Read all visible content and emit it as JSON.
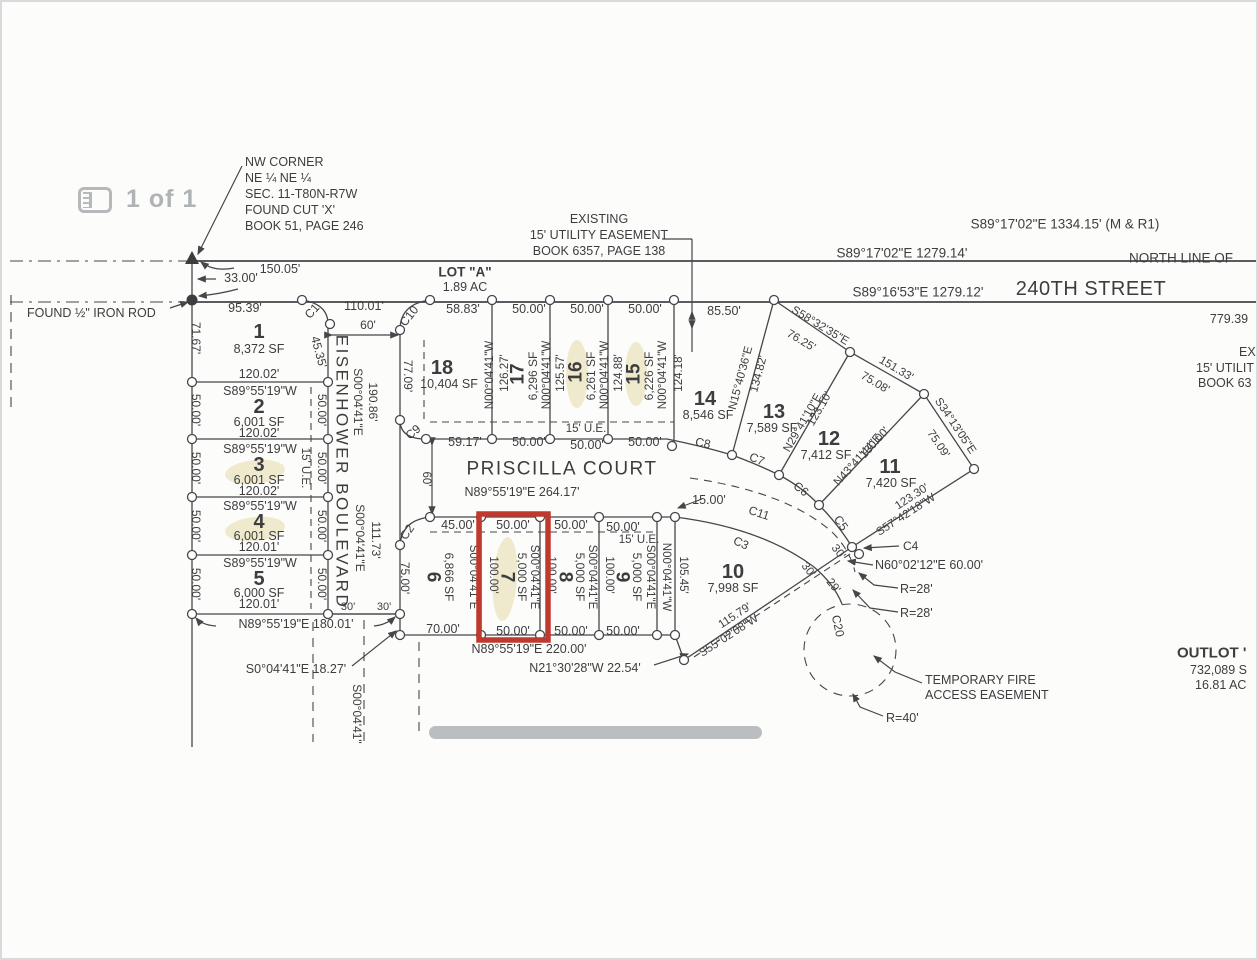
{
  "page": {
    "indicator": "1 of 1"
  },
  "colors": {
    "ink": "#3c3d3f",
    "muted_gray": "#b0b3b6",
    "highlight_red": "#c0392f",
    "redaction_gray": "#b4b7b9",
    "marker_yellow": "#ece4c2"
  },
  "summary": {
    "highlighted_lot": "7",
    "streets": [
      "240TH STREET",
      "EISENHOWER BOULEVARD",
      "PRISCILLA COURT"
    ],
    "outlot_a": {
      "label": "LOT \"A\"",
      "area": "1.89 AC"
    },
    "lots": [
      {
        "lot": "1",
        "area": "8,372 SF"
      },
      {
        "lot": "2",
        "area": "6,001 SF"
      },
      {
        "lot": "3",
        "area": "6,001 SF"
      },
      {
        "lot": "4",
        "area": "6,001 SF"
      },
      {
        "lot": "5",
        "area": "6,000 SF"
      },
      {
        "lot": "6",
        "area": "6,866 SF"
      },
      {
        "lot": "7",
        "area": "5,000 SF"
      },
      {
        "lot": "8",
        "area": "5,000 SF"
      },
      {
        "lot": "9",
        "area": "5,000 SF"
      },
      {
        "lot": "10",
        "area": "7,998 SF"
      },
      {
        "lot": "11",
        "area": "7,420 SF"
      },
      {
        "lot": "12",
        "area": "7,412 SF"
      },
      {
        "lot": "13",
        "area": "7,589 SF"
      },
      {
        "lot": "14",
        "area": "8,546 SF"
      },
      {
        "lot": "15",
        "area": "6,226 SF"
      },
      {
        "lot": "16",
        "area": "6,261 SF"
      },
      {
        "lot": "17",
        "area": "6,296 SF"
      },
      {
        "lot": "18",
        "area": "10,404 SF"
      }
    ]
  },
  "plat": {
    "labels": [
      {
        "t": "NW CORNER",
        "x": 243,
        "y": 160,
        "a": "start"
      },
      {
        "t": "NE ¼ NE ¼",
        "x": 243,
        "y": 176,
        "a": "start"
      },
      {
        "t": "SEC. 11-T80N-R7W",
        "x": 243,
        "y": 192,
        "a": "start"
      },
      {
        "t": "FOUND CUT 'X'",
        "x": 243,
        "y": 208,
        "a": "start"
      },
      {
        "t": "BOOK 51, PAGE 246",
        "x": 243,
        "y": 224,
        "a": "start"
      },
      {
        "t": "FOUND ½\" IRON ROD",
        "x": 25,
        "y": 311,
        "a": "start"
      },
      {
        "t": "EXISTING",
        "x": 597,
        "y": 217
      },
      {
        "t": "15' UTILITY EASEMENT",
        "x": 597,
        "y": 233
      },
      {
        "t": "BOOK 6357, PAGE 138",
        "x": 597,
        "y": 249
      },
      {
        "t": "S89°17'02\"E 1334.15' (M & R1)",
        "x": 1063,
        "y": 222,
        "s": 13.5
      },
      {
        "t": "S89°17'02\"E 1279.14'",
        "x": 900,
        "y": 251,
        "s": 13.5
      },
      {
        "t": "NORTH LINE OF",
        "x": 1127,
        "y": 256,
        "a": "start",
        "s": 13.5
      },
      {
        "t": "240TH STREET",
        "x": 1089,
        "y": 287,
        "s": 20,
        "ls": 0.5
      },
      {
        "t": "S89°16'53\"E 1279.12'",
        "x": 916,
        "y": 290,
        "s": 13.5
      },
      {
        "t": "779.39",
        "x": 1227,
        "y": 317
      },
      {
        "t": "150.05'",
        "x": 278,
        "y": 267
      },
      {
        "t": "33.00'",
        "x": 239,
        "y": 276
      },
      {
        "t": "95.39'",
        "x": 243,
        "y": 306
      },
      {
        "t": "110.01'",
        "x": 362,
        "y": 304
      },
      {
        "t": "LOT \"A\"",
        "x": 463,
        "y": 270,
        "s": 13.5,
        "w": 1
      },
      {
        "t": "1.89 AC",
        "x": 463,
        "y": 285
      },
      {
        "t": "58.83'",
        "x": 461,
        "y": 307
      },
      {
        "t": "50.00'",
        "x": 527,
        "y": 307
      },
      {
        "t": "50.00'",
        "x": 585,
        "y": 307
      },
      {
        "t": "50.00'",
        "x": 643,
        "y": 307
      },
      {
        "t": "85.50'",
        "x": 722,
        "y": 309
      },
      {
        "t": "60'",
        "x": 366,
        "y": 323,
        "s": 12
      },
      {
        "t": "C1",
        "x": 310,
        "y": 309,
        "r": -48,
        "s": 12
      },
      {
        "t": "C10",
        "x": 407,
        "y": 314,
        "r": -52,
        "s": 12
      },
      {
        "t": "EX",
        "x": 1237,
        "y": 350,
        "a": "start"
      },
      {
        "t": "15' UTILIT",
        "x": 1194,
        "y": 366,
        "a": "start"
      },
      {
        "t": "BOOK 63",
        "x": 1196,
        "y": 381,
        "a": "start"
      },
      {
        "t": "OUTLOT '",
        "x": 1175,
        "y": 651,
        "a": "start",
        "s": 15,
        "w": 1
      },
      {
        "t": "732,089 S",
        "x": 1188,
        "y": 668,
        "a": "start"
      },
      {
        "t": "16.81 AC",
        "x": 1193,
        "y": 683,
        "a": "start"
      },
      {
        "t": "1",
        "x": 257,
        "y": 330,
        "s": 20,
        "w": 1
      },
      {
        "t": "8,372 SF",
        "x": 257,
        "y": 347
      },
      {
        "t": "120.02'",
        "x": 257,
        "y": 372
      },
      {
        "t": "S89°55'19\"W",
        "x": 258,
        "y": 389
      },
      {
        "t": "2",
        "x": 257,
        "y": 405,
        "s": 20,
        "w": 1
      },
      {
        "t": "6,001 SF",
        "x": 257,
        "y": 420
      },
      {
        "t": "120.02'",
        "x": 257,
        "y": 431
      },
      {
        "t": "S89°55'19\"W",
        "x": 258,
        "y": 447
      },
      {
        "t": "3",
        "x": 257,
        "y": 463,
        "s": 20,
        "w": 1
      },
      {
        "t": "6,001 SF",
        "x": 257,
        "y": 478
      },
      {
        "t": "120.02'",
        "x": 257,
        "y": 489
      },
      {
        "t": "S89°55'19\"W",
        "x": 258,
        "y": 504
      },
      {
        "t": "4",
        "x": 257,
        "y": 520,
        "s": 20,
        "w": 1
      },
      {
        "t": "6,001 SF",
        "x": 257,
        "y": 534
      },
      {
        "t": "120.01'",
        "x": 257,
        "y": 545
      },
      {
        "t": "S89°55'19\"W",
        "x": 258,
        "y": 561
      },
      {
        "t": "5",
        "x": 257,
        "y": 577,
        "s": 20,
        "w": 1
      },
      {
        "t": "6,000 SF",
        "x": 257,
        "y": 591
      },
      {
        "t": "120.01'",
        "x": 257,
        "y": 602
      },
      {
        "t": "71.67'",
        "x": 194,
        "y": 336,
        "r": 90,
        "s": 12
      },
      {
        "t": "50.00'",
        "x": 194,
        "y": 408,
        "r": 90,
        "s": 12
      },
      {
        "t": "50.00'",
        "x": 194,
        "y": 466,
        "r": 90,
        "s": 12
      },
      {
        "t": "50.00'",
        "x": 194,
        "y": 524,
        "r": 90,
        "s": 12
      },
      {
        "t": "50.00'",
        "x": 194,
        "y": 582,
        "r": 90,
        "s": 12
      },
      {
        "t": "45.35'",
        "x": 317,
        "y": 350,
        "r": 75,
        "s": 12
      },
      {
        "t": "50.00'",
        "x": 320,
        "y": 408,
        "r": 90,
        "s": 12
      },
      {
        "t": "50.00'",
        "x": 320,
        "y": 466,
        "r": 90,
        "s": 12
      },
      {
        "t": "50.00'",
        "x": 320,
        "y": 524,
        "r": 90,
        "s": 12
      },
      {
        "t": "50.00'",
        "x": 320,
        "y": 582,
        "r": 90,
        "s": 12
      },
      {
        "t": "15' U.E.",
        "x": 303,
        "y": 466,
        "r": 90,
        "s": 11.5
      },
      {
        "t": "EISENHOWER BOULEVARD",
        "x": 340,
        "y": 470,
        "r": 90,
        "s": 17,
        "ls": 2.5
      },
      {
        "t": "S00°04'41\"E",
        "x": 356,
        "y": 400,
        "r": 90,
        "s": 12
      },
      {
        "t": "190.86'",
        "x": 371,
        "y": 400,
        "r": 90,
        "s": 12
      },
      {
        "t": "S00°04'41\"E",
        "x": 358,
        "y": 536,
        "r": 90,
        "s": 12
      },
      {
        "t": "111.73'",
        "x": 374,
        "y": 538,
        "r": 90,
        "s": 12
      },
      {
        "t": "77.09'",
        "x": 406,
        "y": 374,
        "r": 90,
        "s": 12
      },
      {
        "t": "30'",
        "x": 346,
        "y": 605,
        "s": 11
      },
      {
        "t": "30'",
        "x": 382,
        "y": 605,
        "s": 11
      },
      {
        "t": "N89°55'19\"E 180.01'",
        "x": 294,
        "y": 622
      },
      {
        "t": "S0°04'41\"E 18.27'",
        "x": 294,
        "y": 667
      },
      {
        "t": "S00°04'41\"",
        "x": 355,
        "y": 712,
        "r": 90,
        "s": 12
      },
      {
        "t": "18",
        "x": 440,
        "y": 366,
        "s": 20,
        "w": 1
      },
      {
        "t": "10,404 SF",
        "x": 447,
        "y": 382
      },
      {
        "t": "C9",
        "x": 411,
        "y": 430,
        "r": -40,
        "s": 12
      },
      {
        "t": "C2",
        "x": 405,
        "y": 530,
        "r": -55,
        "s": 12
      },
      {
        "t": "59.17'",
        "x": 463,
        "y": 440
      },
      {
        "t": "50.00'",
        "x": 527,
        "y": 440
      },
      {
        "t": "50.00'",
        "x": 585,
        "y": 443
      },
      {
        "t": "50.00'",
        "x": 643,
        "y": 440
      },
      {
        "t": "15' U.E.",
        "x": 584,
        "y": 427,
        "s": 11.5
      },
      {
        "t": "N00°04'41\"W",
        "x": 488,
        "y": 373,
        "r": -90,
        "s": 11.5
      },
      {
        "t": "126.27'",
        "x": 503,
        "y": 371,
        "r": -90,
        "s": 11.5
      },
      {
        "t": "17",
        "x": 516,
        "y": 372,
        "r": -90,
        "s": 19,
        "w": 1
      },
      {
        "t": "6,296 SF",
        "x": 531,
        "y": 374,
        "r": -90,
        "s": 12
      },
      {
        "t": "N00°04'41\"W",
        "x": 545,
        "y": 373,
        "r": -90,
        "s": 11.5
      },
      {
        "t": "125.57'",
        "x": 559,
        "y": 371,
        "r": -90,
        "s": 11.5
      },
      {
        "t": "16",
        "x": 574,
        "y": 370,
        "r": -90,
        "s": 19,
        "w": 1
      },
      {
        "t": "6,261 SF",
        "x": 589,
        "y": 374,
        "r": -90,
        "s": 12
      },
      {
        "t": "N00°04'41\"W",
        "x": 603,
        "y": 373,
        "r": -90,
        "s": 11.5
      },
      {
        "t": "124.88'",
        "x": 617,
        "y": 371,
        "r": -90,
        "s": 11.5
      },
      {
        "t": "15",
        "x": 632,
        "y": 372,
        "r": -90,
        "s": 19,
        "w": 1
      },
      {
        "t": "6,226 SF",
        "x": 647,
        "y": 374,
        "r": -90,
        "s": 12
      },
      {
        "t": "N00°04'41\"W",
        "x": 661,
        "y": 373,
        "r": -90,
        "s": 11.5
      },
      {
        "t": "124.18'",
        "x": 677,
        "y": 371,
        "r": -90,
        "s": 11.5
      },
      {
        "t": "14",
        "x": 703,
        "y": 397,
        "s": 20,
        "w": 1
      },
      {
        "t": "8,546 SF",
        "x": 706,
        "y": 413
      },
      {
        "t": "N15°40'36\"E",
        "x": 739,
        "y": 376,
        "r": -75,
        "s": 11.5
      },
      {
        "t": "134.82'",
        "x": 757,
        "y": 372,
        "r": -75,
        "s": 11.5
      },
      {
        "t": "13",
        "x": 772,
        "y": 410,
        "s": 20,
        "w": 1
      },
      {
        "t": "7,589 SF",
        "x": 770,
        "y": 426
      },
      {
        "t": "S58°32'35\"E",
        "x": 818,
        "y": 324,
        "r": 31,
        "s": 11.5
      },
      {
        "t": "76.25'",
        "x": 799,
        "y": 339,
        "r": 31,
        "s": 11.5
      },
      {
        "t": "151.33'",
        "x": 894,
        "y": 367,
        "r": 31,
        "s": 11.5
      },
      {
        "t": "75.08'",
        "x": 873,
        "y": 381,
        "r": 31,
        "s": 11.5
      },
      {
        "t": "N29°41'10\"E",
        "x": 801,
        "y": 421,
        "r": -60,
        "s": 11.5
      },
      {
        "t": "123.10'",
        "x": 818,
        "y": 407,
        "r": -60,
        "s": 11.5
      },
      {
        "t": "12",
        "x": 827,
        "y": 437,
        "s": 20,
        "w": 1
      },
      {
        "t": "7,412 SF",
        "x": 824,
        "y": 453
      },
      {
        "t": "N43°41'44\"E",
        "x": 856,
        "y": 458,
        "r": -48,
        "s": 11.5
      },
      {
        "t": "130.00'",
        "x": 873,
        "y": 441,
        "r": -48,
        "s": 11.5
      },
      {
        "t": "11",
        "x": 888,
        "y": 465,
        "s": 20,
        "w": 1
      },
      {
        "t": "7,420 SF",
        "x": 889,
        "y": 481
      },
      {
        "t": "S34°13'05\"E",
        "x": 953,
        "y": 424,
        "r": 56,
        "s": 11.5
      },
      {
        "t": "75.09'",
        "x": 936,
        "y": 442,
        "r": 56,
        "s": 11.5
      },
      {
        "t": "123.30'",
        "x": 910,
        "y": 495,
        "r": -33,
        "s": 11.5
      },
      {
        "t": "S57°42'18\"W",
        "x": 904,
        "y": 513,
        "r": -33,
        "s": 11.5
      },
      {
        "t": "C8",
        "x": 701,
        "y": 441,
        "r": 12,
        "s": 12
      },
      {
        "t": "C7",
        "x": 755,
        "y": 457,
        "r": 22,
        "s": 12
      },
      {
        "t": "C6",
        "x": 799,
        "y": 487,
        "r": 38,
        "s": 12
      },
      {
        "t": "C5",
        "x": 839,
        "y": 521,
        "r": 55,
        "s": 12
      },
      {
        "t": "C4",
        "x": 901,
        "y": 544,
        "a": "start",
        "s": 12
      },
      {
        "t": "PRISCILLA COURT",
        "x": 560,
        "y": 467,
        "s": 19,
        "ls": 1.5
      },
      {
        "t": "N89°55'19\"E  264.17'",
        "x": 520,
        "y": 490
      },
      {
        "t": "60'",
        "x": 424,
        "y": 477,
        "r": 90,
        "s": 11.5
      },
      {
        "t": "15.00'",
        "x": 707,
        "y": 498
      },
      {
        "t": "C11",
        "x": 757,
        "y": 511,
        "r": 18,
        "s": 12
      },
      {
        "t": "C3",
        "x": 739,
        "y": 541,
        "r": 25,
        "s": 12
      },
      {
        "t": "10",
        "x": 731,
        "y": 570,
        "s": 20,
        "w": 1
      },
      {
        "t": "7,998 SF",
        "x": 731,
        "y": 586
      },
      {
        "t": "30'",
        "x": 806,
        "y": 568,
        "r": 52,
        "s": 11.5
      },
      {
        "t": "30'",
        "x": 836,
        "y": 550,
        "r": 52,
        "s": 11.5
      },
      {
        "t": "29'",
        "x": 831,
        "y": 584,
        "r": 52,
        "s": 11.5
      },
      {
        "t": "115.79'",
        "x": 733,
        "y": 614,
        "r": -33,
        "s": 11.5
      },
      {
        "t": "S55°02'08\"W",
        "x": 727,
        "y": 634,
        "r": -33,
        "s": 11.5
      },
      {
        "t": "N60°02'12\"E 60.00'",
        "x": 873,
        "y": 563,
        "a": "start"
      },
      {
        "t": "R=28'",
        "x": 898,
        "y": 587,
        "a": "start"
      },
      {
        "t": "R=28'",
        "x": 898,
        "y": 611,
        "a": "start"
      },
      {
        "t": "C20",
        "x": 836,
        "y": 624,
        "r": 78,
        "s": 12
      },
      {
        "t": "R=40'",
        "x": 884,
        "y": 716,
        "a": "start"
      },
      {
        "t": "TEMPORARY FIRE",
        "x": 923,
        "y": 678,
        "a": "start"
      },
      {
        "t": "ACCESS EASEMENT",
        "x": 923,
        "y": 693,
        "a": "start"
      },
      {
        "t": "45.00'",
        "x": 456,
        "y": 523
      },
      {
        "t": "50.00'",
        "x": 511,
        "y": 523
      },
      {
        "t": "50.00'",
        "x": 569,
        "y": 523
      },
      {
        "t": "50.00'",
        "x": 621,
        "y": 525
      },
      {
        "t": "15' U.E.",
        "x": 637,
        "y": 538,
        "s": 11.5
      },
      {
        "t": "75.00'",
        "x": 403,
        "y": 576,
        "r": 90,
        "s": 12
      },
      {
        "t": "6",
        "x": 431,
        "y": 575,
        "r": 90,
        "s": 19,
        "w": 1
      },
      {
        "t": "6,866 SF",
        "x": 447,
        "y": 575,
        "r": 90,
        "s": 12
      },
      {
        "t": "S00°04'41\"E",
        "x": 471,
        "y": 575,
        "r": 90,
        "s": 11.5
      },
      {
        "t": "100.00'",
        "x": 491,
        "y": 573,
        "r": 90,
        "s": 11.5
      },
      {
        "t": "7",
        "x": 505,
        "y": 575,
        "r": 90,
        "s": 19,
        "w": 1
      },
      {
        "t": "5,000 SF",
        "x": 520,
        "y": 575,
        "r": 90,
        "s": 12
      },
      {
        "t": "S00°04'41\"E",
        "x": 532,
        "y": 575,
        "r": 90,
        "s": 11.5
      },
      {
        "t": "100.00'",
        "x": 549,
        "y": 573,
        "r": 90,
        "s": 11.5
      },
      {
        "t": "8",
        "x": 563,
        "y": 575,
        "r": 90,
        "s": 19,
        "w": 1
      },
      {
        "t": "5,000 SF",
        "x": 578,
        "y": 575,
        "r": 90,
        "s": 12
      },
      {
        "t": "S00°04'41\"E",
        "x": 590,
        "y": 575,
        "r": 90,
        "s": 11.5
      },
      {
        "t": "100.00'",
        "x": 607,
        "y": 573,
        "r": 90,
        "s": 11.5
      },
      {
        "t": "9",
        "x": 620,
        "y": 575,
        "r": 90,
        "s": 19,
        "w": 1
      },
      {
        "t": "5,000 SF",
        "x": 635,
        "y": 575,
        "r": 90,
        "s": 12
      },
      {
        "t": "S00°04'41\"E",
        "x": 648,
        "y": 575,
        "r": 90,
        "s": 11.5
      },
      {
        "t": "N00°04'41\"W",
        "x": 664,
        "y": 575,
        "r": 90,
        "s": 11.5
      },
      {
        "t": "105.45'",
        "x": 681,
        "y": 573,
        "r": 90,
        "s": 11.5
      },
      {
        "t": "70.00'",
        "x": 441,
        "y": 627
      },
      {
        "t": "50.00'",
        "x": 511,
        "y": 629
      },
      {
        "t": "50.00'",
        "x": 569,
        "y": 629
      },
      {
        "t": "50.00'",
        "x": 621,
        "y": 629
      },
      {
        "t": "N89°55'19\"E 220.00'",
        "x": 527,
        "y": 647
      },
      {
        "t": "N21°30'28\"W 22.54'",
        "x": 583,
        "y": 666
      }
    ]
  }
}
